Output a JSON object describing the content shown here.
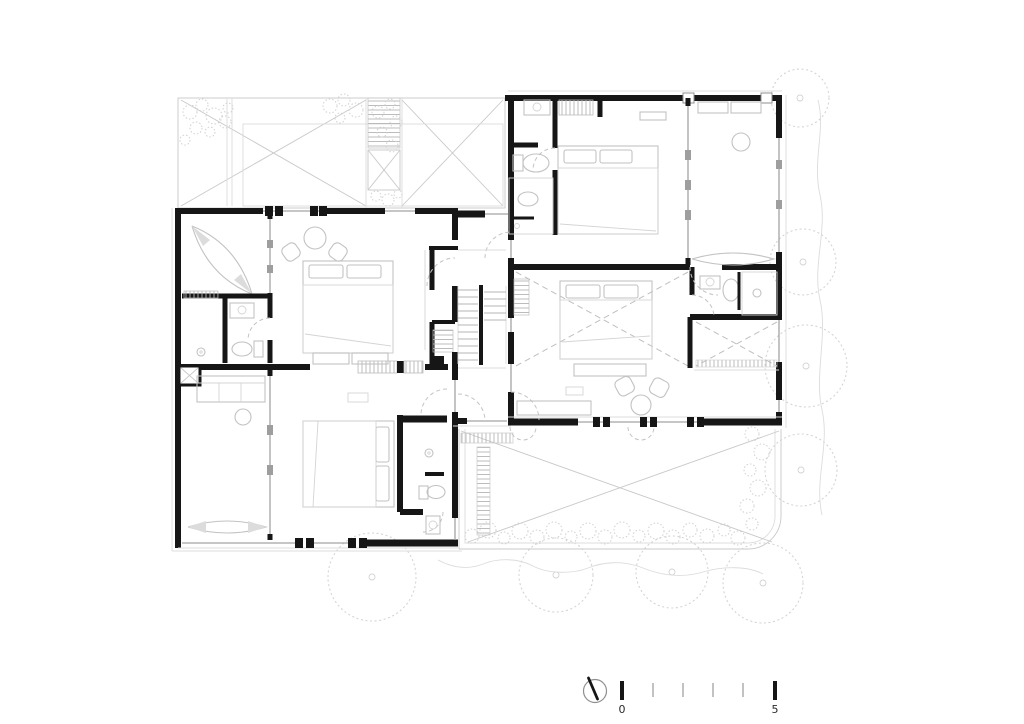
{
  "document": {
    "kind": "architectural floor plan",
    "sheet_background": "#ffffff"
  },
  "palette": {
    "wall": "#161616",
    "glass": "#a3a3a3",
    "furniture": "#c2c2c2",
    "faint_line": "#dcdcdc",
    "dashed_line": "#c4c4c4",
    "vegetation": "#d4d4d4",
    "label_text": "#2a2a2a",
    "minor_tick": "#c2c2c2"
  },
  "legend": {
    "north_arrow_icon": "north-arrow-icon",
    "scale_bar": {
      "start_label": "0",
      "end_label": "5",
      "tick_count": 6
    }
  }
}
